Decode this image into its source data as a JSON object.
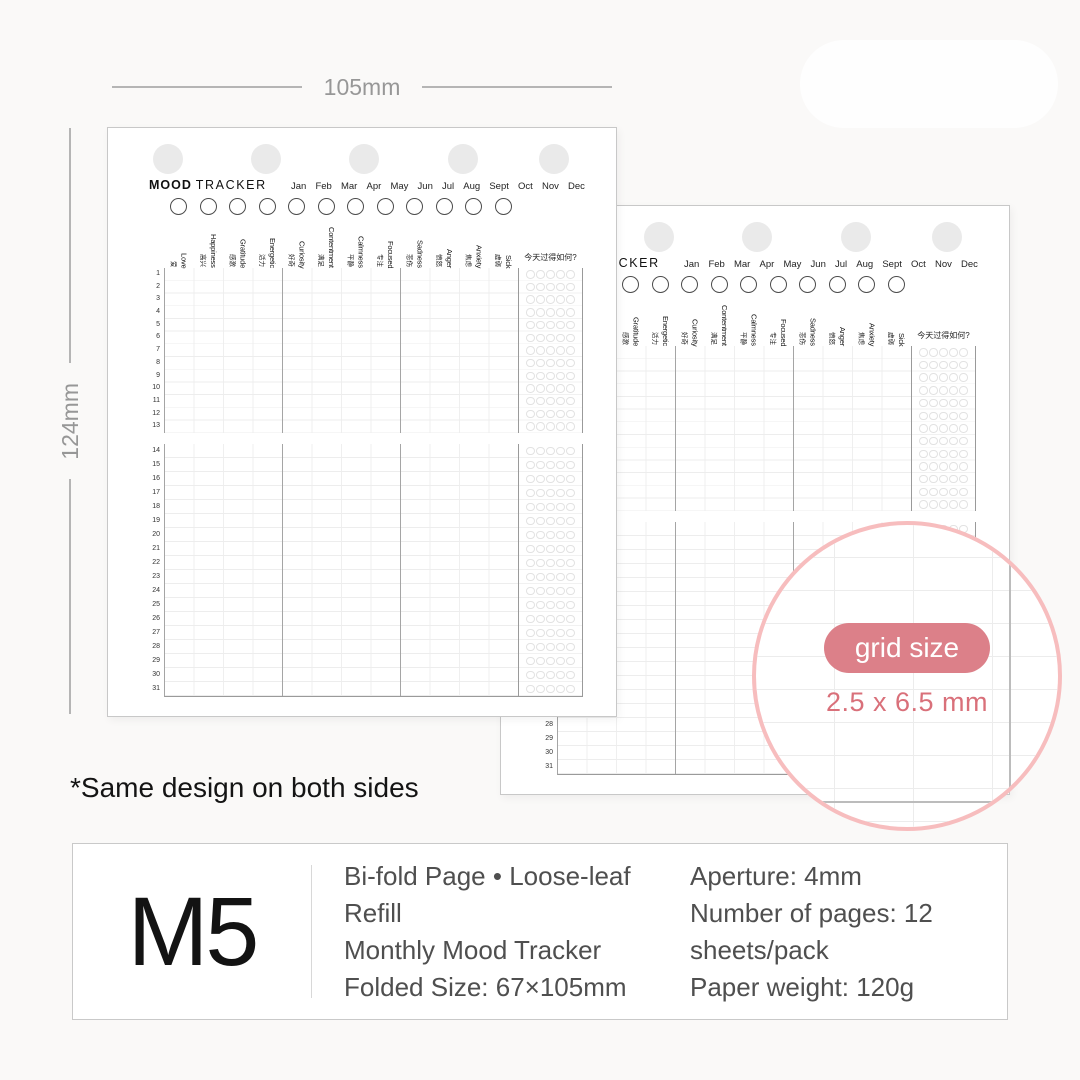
{
  "dimensions": {
    "width_label": "105mm",
    "height_label": "124mm"
  },
  "note": "*Same design on both sides",
  "magnifier": {
    "badge_label": "grid size",
    "size_label": "2.5 x 6.5 mm",
    "badge_color": "#dc8089",
    "text_color": "#d9707a",
    "ring_color": "#f7bdbe"
  },
  "page": {
    "title_bold": "MOOD",
    "title_rest": "TRACKER",
    "months": [
      "Jan",
      "Feb",
      "Mar",
      "Apr",
      "May",
      "Jun",
      "Jul",
      "Aug",
      "Sept",
      "Oct",
      "Nov",
      "Dec"
    ],
    "moods": [
      {
        "en": "Love",
        "zh": "爱"
      },
      {
        "en": "Happiness",
        "zh": "高兴"
      },
      {
        "en": "Gratitude",
        "zh": "感激"
      },
      {
        "en": "Energetic",
        "zh": "活力"
      },
      {
        "en": "Curiosity",
        "zh": "好奇"
      },
      {
        "en": "Contentment",
        "zh": "满足"
      },
      {
        "en": "Calmness",
        "zh": "平静"
      },
      {
        "en": "Focused",
        "zh": "专注"
      },
      {
        "en": "Sadness",
        "zh": "悲伤"
      },
      {
        "en": "Anger",
        "zh": "愤怒"
      },
      {
        "en": "Anxiety",
        "zh": "焦虑"
      },
      {
        "en": "Sick",
        "zh": "虚弱"
      }
    ],
    "day_question": "今天过得如何?",
    "days_top": [
      1,
      2,
      3,
      4,
      5,
      6,
      7,
      8,
      9,
      10,
      11,
      12,
      13
    ],
    "days_bottom": [
      14,
      15,
      16,
      17,
      18,
      19,
      20,
      21,
      22,
      23,
      24,
      25,
      26,
      27,
      28,
      29,
      30,
      31
    ],
    "rating_circles_per_day": 5,
    "punch_hole_count": 5
  },
  "info_box": {
    "size_code": "M5",
    "description": [
      "Bi-fold Page • Loose-leaf Refill",
      "Monthly Mood Tracker",
      "Folded Size: 67×105mm"
    ],
    "specs": [
      "Aperture: 4mm",
      "Number of pages: 12 sheets/pack",
      "Paper weight: 120g"
    ]
  }
}
